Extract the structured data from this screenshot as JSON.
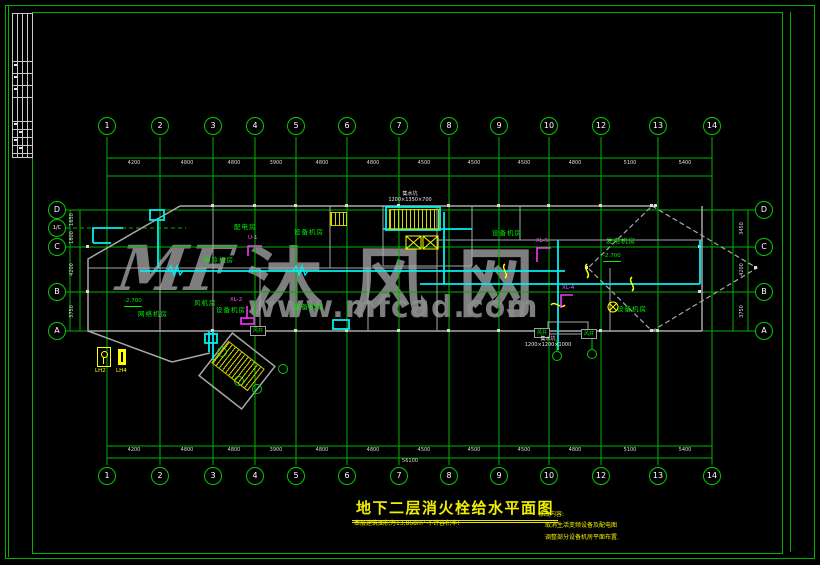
{
  "watermark": {
    "logo": "MF",
    "site_name": "沐风网",
    "site_url": "www.mfcad.com"
  },
  "title": {
    "main": "地下二层消火栓给水平面图",
    "subtitle": "本层建筑面积为13,868m² 不计容积率!"
  },
  "notes": {
    "heading": "修改内容:",
    "line1": "取消生活变频设备及配电图",
    "line2": "调整部分设备机房平面布置."
  },
  "axes": {
    "top": [
      "1",
      "2",
      "3",
      "4",
      "5",
      "6",
      "7",
      "8",
      "9",
      "10",
      "12",
      "13",
      "14"
    ],
    "bottom": [
      "1",
      "2",
      "3",
      "4",
      "5",
      "6",
      "7",
      "8",
      "9",
      "10",
      "12",
      "13",
      "14"
    ],
    "left": [
      "D",
      "1/C",
      "C",
      "B",
      "A"
    ],
    "right": [
      "D",
      "C",
      "B",
      "A"
    ]
  },
  "dimensions": {
    "top": [
      "4200",
      "4800",
      "4800",
      "3900",
      "4800",
      "4800",
      "4500",
      "4500",
      "4500",
      "4800",
      "5100",
      "5400"
    ],
    "bottom": [
      "4200",
      "4800",
      "4800",
      "3900",
      "4800",
      "4800",
      "4500",
      "4500",
      "4500",
      "4800",
      "5100",
      "5400"
    ],
    "total": "56100",
    "left": [
      "1650",
      "1800",
      "4200",
      "3750"
    ],
    "right": [
      "3450",
      "4200",
      "3750"
    ]
  },
  "rooms": [
    "配电房",
    "制冷机房",
    "网络机房",
    "风机房",
    "设备机房",
    "设备机房",
    "设备机房",
    "发电机房",
    "设备机房",
    "设备机房"
  ],
  "labels": {
    "shaft": "风井",
    "sump1_name": "集水坑",
    "sump1_size": "1200×1350×700",
    "sump2_name": "集水坑",
    "sump2_size": "1200×1200×1000",
    "elev1": "-2.700",
    "elev2": "-2.700"
  },
  "risers": [
    "U-1",
    "XL-2",
    "XL-5",
    "XL-4"
  ],
  "legend": {
    "lh2": "LH2",
    "lh4": "LH4"
  },
  "colors": {
    "frame_green": "#00b300",
    "bright_green": "#00ee00",
    "cyan": "#00ffff",
    "yellow": "#ffff00",
    "magenta": "#ff00ff",
    "wall_gray": "#a8a8a8",
    "watermark_gray": "#8c8c8c"
  }
}
